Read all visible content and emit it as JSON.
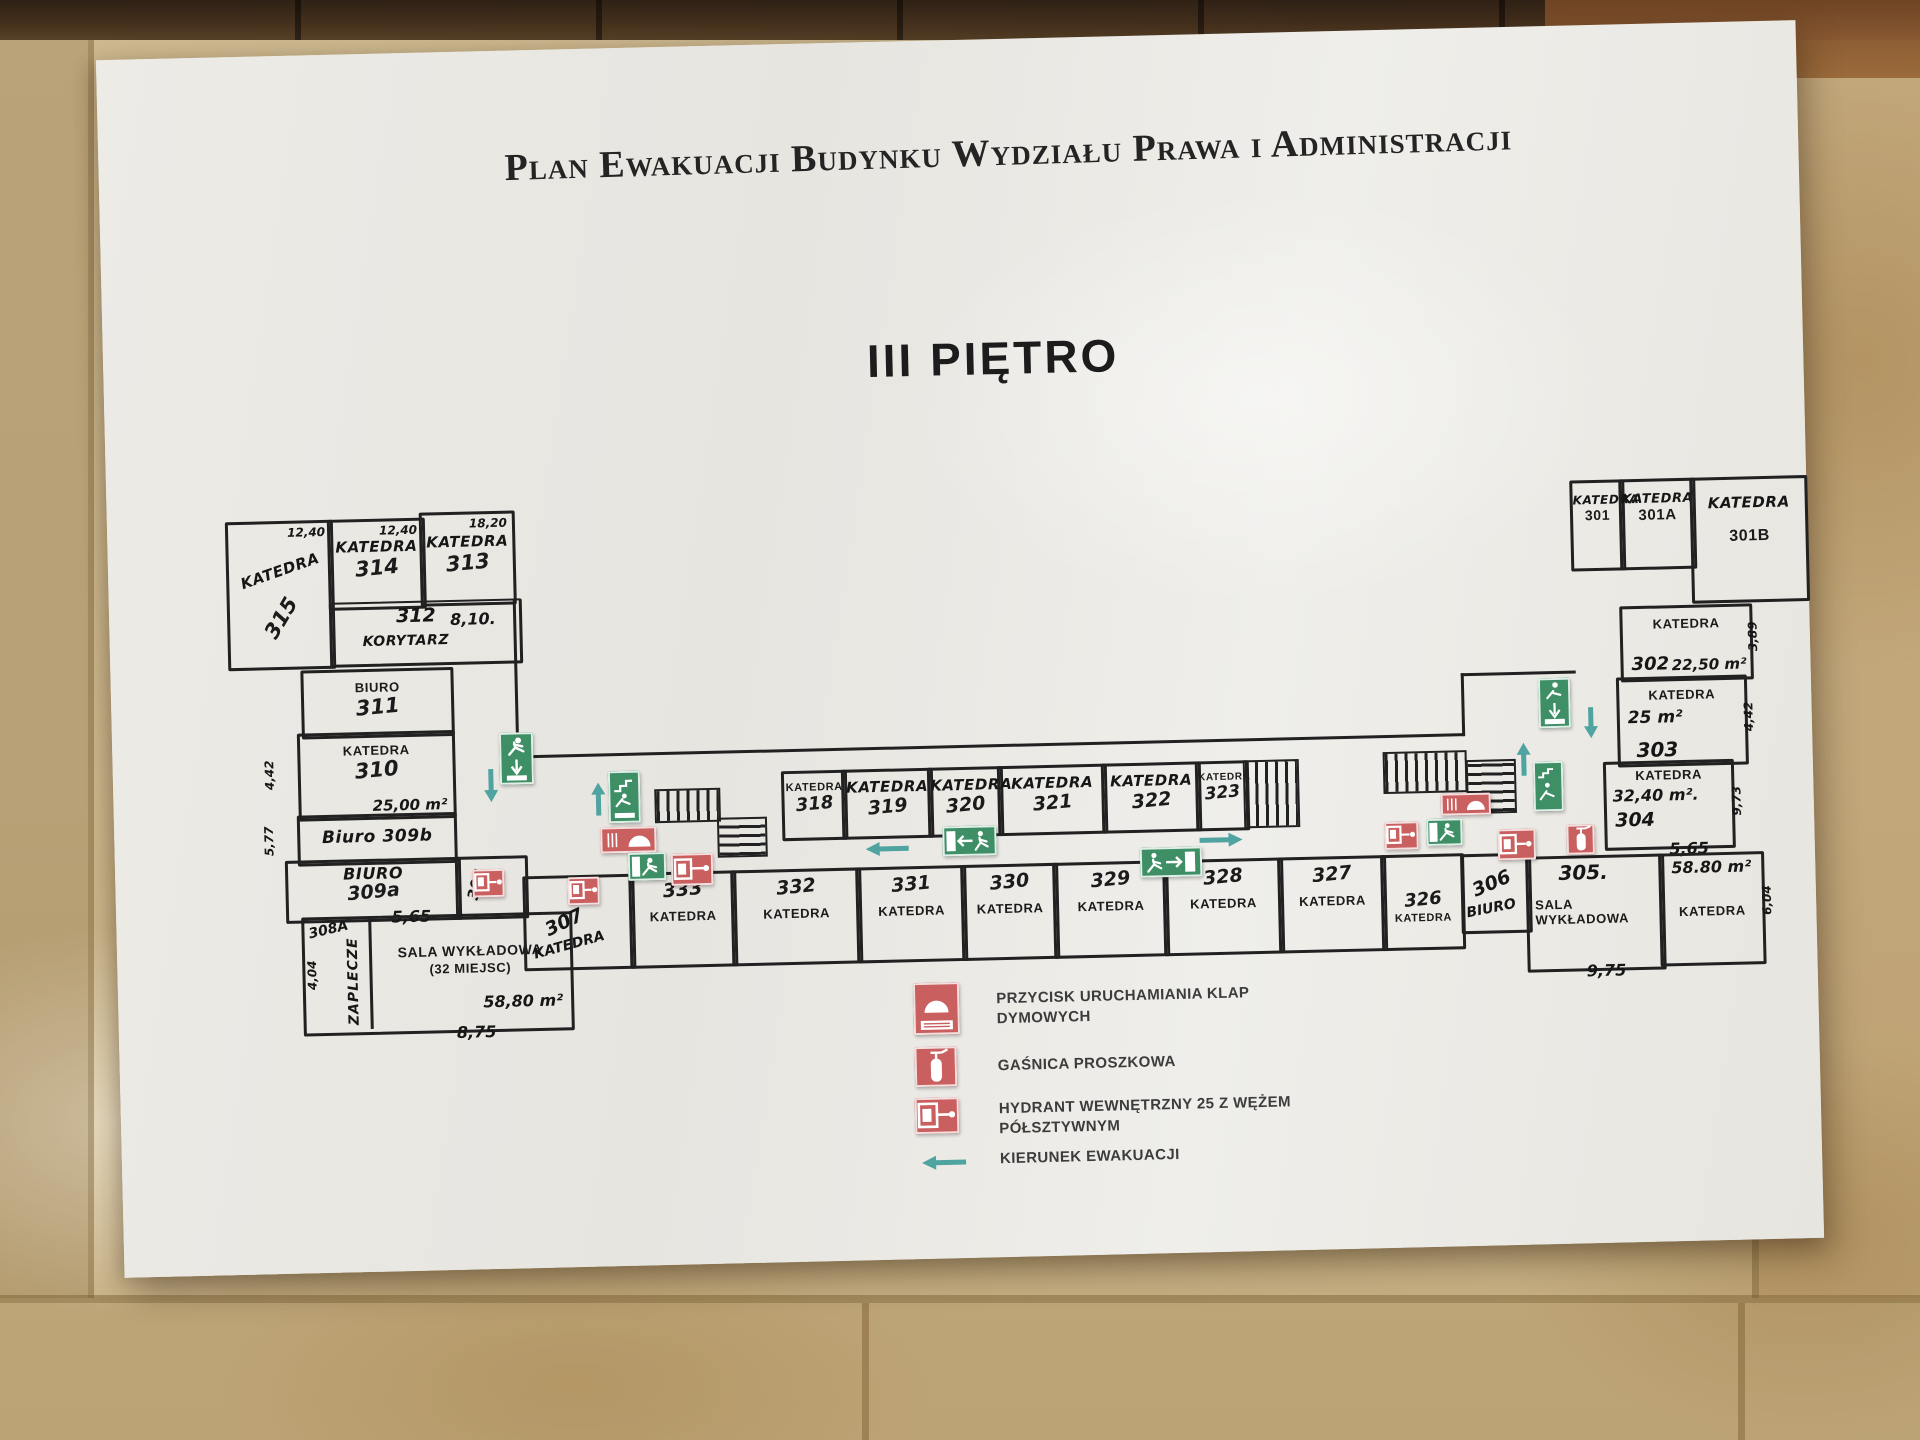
{
  "header": {
    "title": "Plan Ewakuacji Budynku Wydziału Prawa i Administracji",
    "floor": "III PIĘTRO"
  },
  "colors": {
    "paper": "#EAE8E2",
    "wall_tile": "#CBB68C",
    "top_tile": "#45301D",
    "plan_line": "#212121",
    "exit_green": "#3E8F66",
    "safety_red": "#C95F5F",
    "evacuation_teal": "#4FA3A0"
  },
  "plan": {
    "left_wing": {
      "r315": {
        "type": "KATEDRA",
        "number": "315",
        "dim": "12,40"
      },
      "r314": {
        "type": "KATEDRA",
        "number": "314",
        "dim": "12,40"
      },
      "r313": {
        "type": "KATEDRA",
        "number": "313",
        "dim": "18,20"
      },
      "korytarz": {
        "number": "312",
        "dim": "8,10.",
        "label": "KORYTARZ"
      },
      "r311": {
        "type": "BIURO",
        "number": "311"
      },
      "r310": {
        "type": "KATEDRA",
        "number": "310",
        "area": "25,00 m²",
        "dim_left": "4,42"
      },
      "r309b": {
        "label": "Biuro 309b",
        "dim_left": "5,77"
      },
      "r309a": {
        "type": "BIURO",
        "number": "309a",
        "dim_bottom": "5,65"
      },
      "r308": {
        "number": "308"
      },
      "r308a": {
        "number": "308A"
      },
      "zaplecze": {
        "label": "ZAPLECZE",
        "dim_left": "4,04"
      },
      "sala": {
        "type": "SALA WYKŁADOWA",
        "seats": "(32 MIEJSC)",
        "area": "58,80 m²",
        "dim_bottom": "8,75"
      },
      "r307": {
        "number": "307",
        "type": "KATEDRA"
      }
    },
    "middle": {
      "top": [
        {
          "type": "KATEDRA",
          "number": "318"
        },
        {
          "type": "KATEDRA",
          "number": "319"
        },
        {
          "type": "KATEDRA",
          "number": "320"
        },
        {
          "type": "KATEDRA",
          "number": "321"
        },
        {
          "type": "KATEDRA",
          "number": "322"
        },
        {
          "type": "KATEDRA",
          "number": "323"
        }
      ],
      "bottom": [
        {
          "number": "333",
          "type": "KATEDRA"
        },
        {
          "number": "332",
          "type": "KATEDRA"
        },
        {
          "number": "331",
          "type": "KATEDRA"
        },
        {
          "number": "330",
          "type": "KATEDRA"
        },
        {
          "number": "329",
          "type": "KATEDRA"
        },
        {
          "number": "328",
          "type": "KATEDRA"
        },
        {
          "number": "327",
          "type": "KATEDRA"
        },
        {
          "number": "326",
          "type": "KATEDRA"
        }
      ]
    },
    "right_wing": {
      "r301": {
        "type": "KATEDRA",
        "number": "301"
      },
      "r301a": {
        "type": "KATEDRA",
        "number": "301A"
      },
      "r301b": {
        "type": "KATEDRA",
        "number": "301B"
      },
      "r302": {
        "type": "KATEDRA",
        "number": "302",
        "area": "22,50 m²",
        "dim_right": "3,89"
      },
      "r303": {
        "type": "KATEDRA",
        "area": "25 m²",
        "number": "303",
        "dim_right": "4,42"
      },
      "r304": {
        "type": "KATEDRA",
        "area": "32,40 m².",
        "number": "304",
        "dim_bottom": "5,65",
        "dim_right": "9,73"
      },
      "r306": {
        "number": "306",
        "type": "BIURO"
      },
      "r305": {
        "number": "305.",
        "type": "SALA WYKŁADOWA",
        "dim_bottom": "9,75"
      },
      "rkat": {
        "area": "58.80 m²",
        "type": "KATEDRA",
        "dim_right": "6,04"
      }
    }
  },
  "legend": {
    "items": [
      {
        "icon": "smoke-flap-button-icon",
        "label": "PRZYCISK URUCHAMIANIA KLAP DYMOWYCH"
      },
      {
        "icon": "fire-extinguisher-icon",
        "label": "GAŚNICA PROSZKOWA"
      },
      {
        "icon": "hydrant-icon",
        "label": "HYDRANT WEWNĘTRZNY 25 Z WĘŻEM PÓŁSZTYWNYM"
      },
      {
        "icon": "evacuation-arrow-icon",
        "label": "KIERUNEK EWAKUACJI"
      }
    ]
  }
}
